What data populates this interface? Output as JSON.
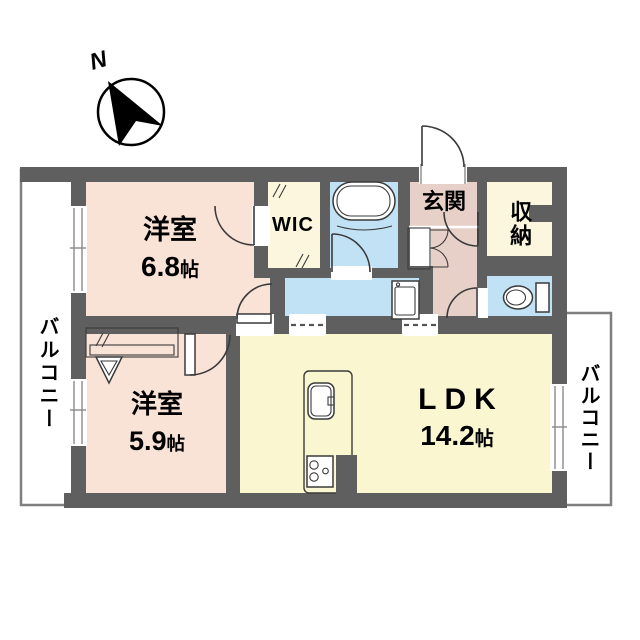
{
  "compass": {
    "label": "N"
  },
  "rooms": {
    "bedroom1": {
      "name": "洋室",
      "size_value": "6.8",
      "size_unit": "帖"
    },
    "bedroom2": {
      "name": "洋室",
      "size_value": "5.9",
      "size_unit": "帖"
    },
    "ldk": {
      "name": "LDK",
      "size_value": "14.2",
      "size_unit": "帖"
    },
    "wic": {
      "label": "WIC"
    },
    "entrance": {
      "label": "玄関"
    },
    "storage": {
      "label": "収納"
    },
    "balcony_left": {
      "label": "バルコニー"
    },
    "balcony_right": {
      "label": "バルコニー"
    }
  },
  "colors": {
    "wall": "#5f5f5f",
    "room_peach": "#f9e2d6",
    "room_yellow": "#faf6d0",
    "room_cream": "#fbf6dd",
    "room_blue": "#c0e2f4",
    "room_pink": "#e7d0c8",
    "line": "#3a3a3a",
    "balcony_border": "#7f7f7f"
  }
}
